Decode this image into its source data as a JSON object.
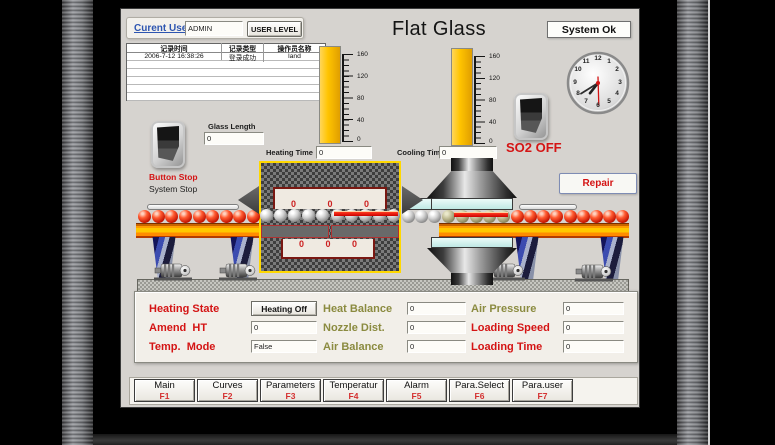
{
  "header": {
    "current_user_label": "Curent User",
    "current_user_value": "ADMIN",
    "user_level_button": "USER LEVEL",
    "title": "Flat Glass",
    "system_status": "System Ok"
  },
  "log_table": {
    "headers": [
      "记录时间",
      "记录类型",
      "操作员名称"
    ],
    "row": [
      "2006-7-12 16:38:26",
      "登录成功",
      "land"
    ]
  },
  "gauges": {
    "scale": [
      "160",
      "120",
      "80",
      "40",
      "0"
    ]
  },
  "fields": {
    "glass_length_label": "Glass Length",
    "glass_length_value": "0",
    "heating_time_label": "Heating Time",
    "heating_time_value": "0",
    "cooling_time_label": "Cooling Time",
    "cooling_time_value": "0"
  },
  "switches": {
    "stop_line1": "Button Stop",
    "stop_line2": "System Stop",
    "so2_label": "SO2 OFF"
  },
  "repair_button": "Repair",
  "furnace": {
    "top_values": [
      "0",
      "0",
      "0"
    ],
    "bottom_values": [
      "0",
      "0",
      "0"
    ]
  },
  "params": {
    "rows": [
      {
        "left_label": "Heating State",
        "left_value": "Heating Off",
        "mid_label": "Heat Balance",
        "mid_value": "0",
        "right_label": "Air Pressure",
        "right_value": "0"
      },
      {
        "left_label": "Amend  HT",
        "left_value": "0",
        "mid_label": "Nozzle Dist.",
        "mid_value": "0",
        "right_label": "Loading Speed",
        "right_value": "0"
      },
      {
        "left_label": "Temp.  Mode",
        "left_value": "False",
        "mid_label": "Air Balance",
        "mid_value": "0",
        "right_label": "Loading Time",
        "right_value": "0"
      }
    ]
  },
  "menu": [
    {
      "label": "Main",
      "fkey": "F1"
    },
    {
      "label": "Curves",
      "fkey": "F2"
    },
    {
      "label": "Parameters",
      "fkey": "F3"
    },
    {
      "label": "Temperatur",
      "fkey": "F4"
    },
    {
      "label": "Alarm",
      "fkey": "F5"
    },
    {
      "label": "Para.Select",
      "fkey": "F6"
    },
    {
      "label": "Para.user",
      "fkey": "F7"
    }
  ],
  "clock": {
    "numbers": [
      "12",
      "1",
      "2",
      "3",
      "4",
      "5",
      "6",
      "7",
      "8",
      "9",
      "10",
      "11"
    ]
  },
  "colors": {
    "alert_red": "#d41414",
    "label_olive": "#8b8b40",
    "gauge_yellow": "#ffc400",
    "furnace_border": "#ffd800",
    "glass_cyan": "#cdeeec",
    "screen_bg": "#d6d3cf"
  }
}
